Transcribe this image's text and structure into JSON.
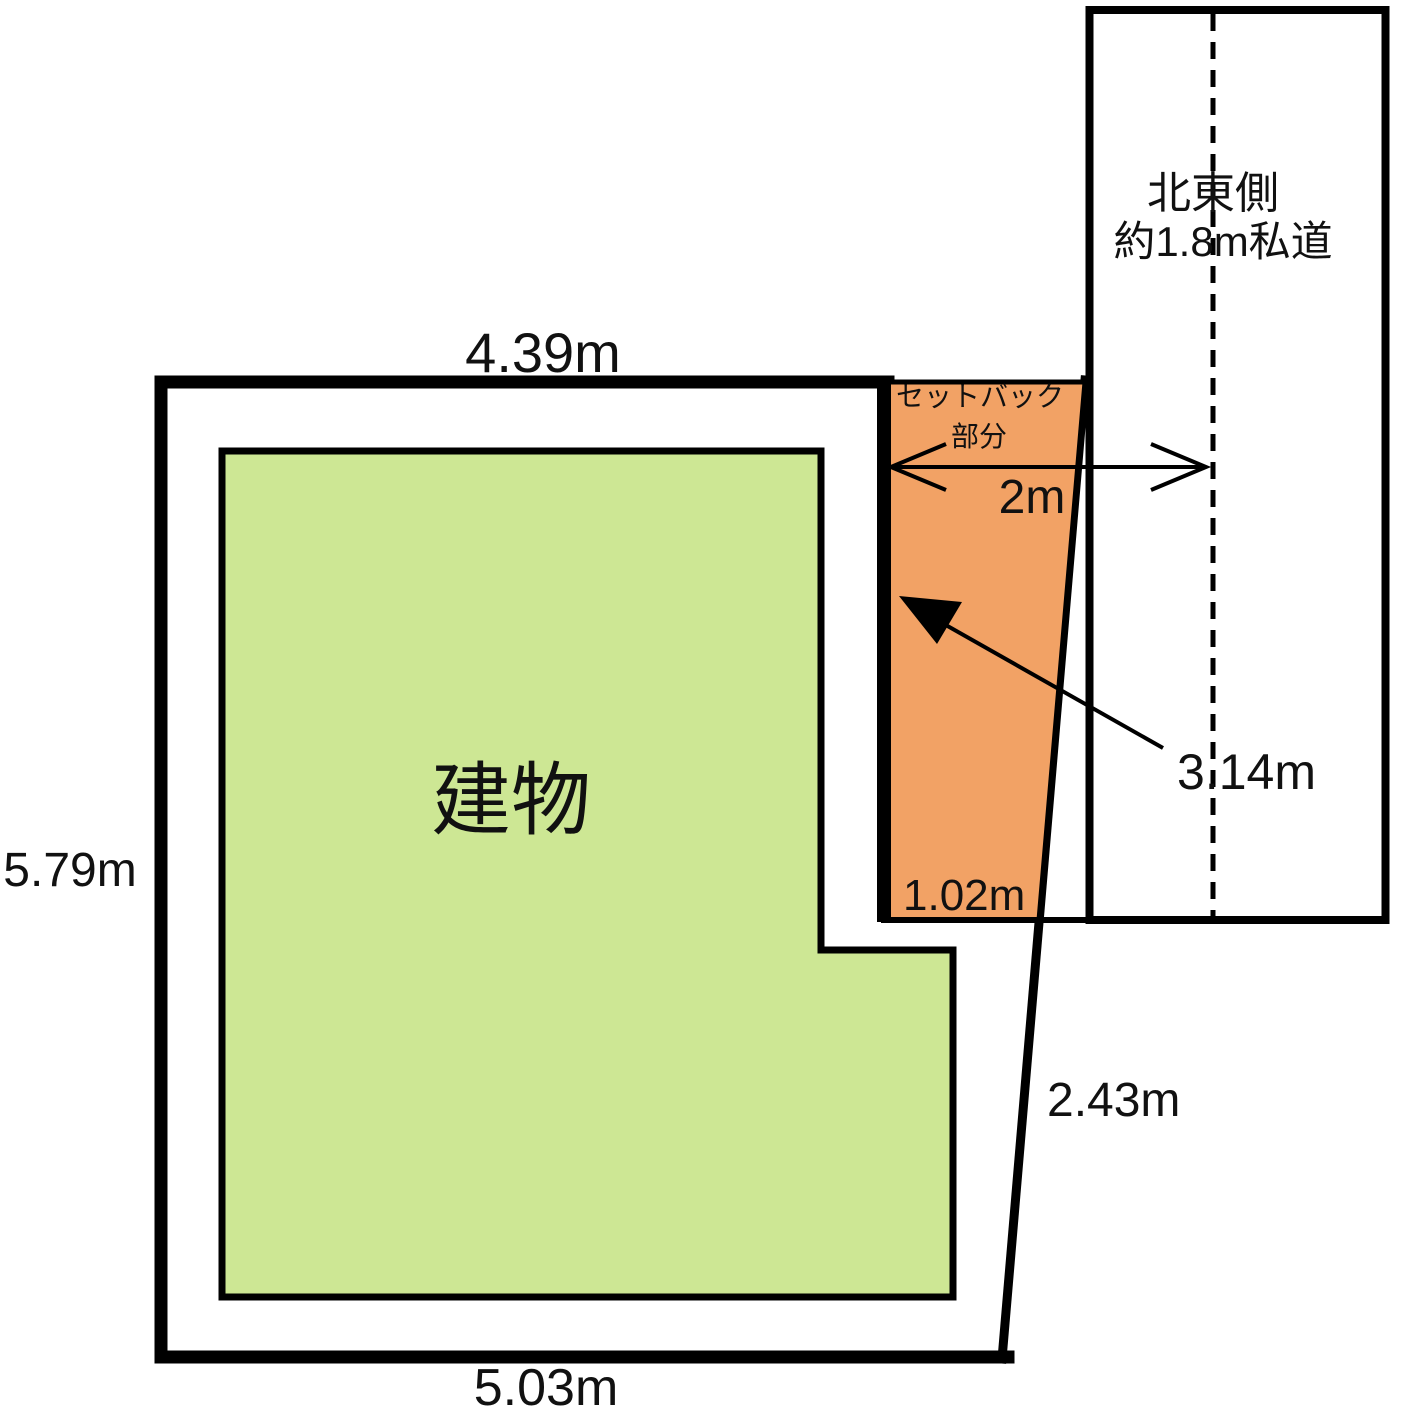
{
  "colors": {
    "background": "#ffffff",
    "outline": "#000000",
    "building_fill": "#cde794",
    "setback_fill": "#f2a265"
  },
  "labels": {
    "building": "建物",
    "top_width": "4.39m",
    "left_height": "5.79m",
    "bottom_width": "5.03m",
    "east_boundary_length": "2.43m",
    "setback_caption_line1": "セットバック",
    "setback_caption_line2": "部分",
    "setback_bottom_width": "1.02m",
    "setback_length": "3.14m",
    "road_center_distance": "2m",
    "road_caption_line1": "北東側",
    "road_caption_line2": "約1.8m私道"
  }
}
